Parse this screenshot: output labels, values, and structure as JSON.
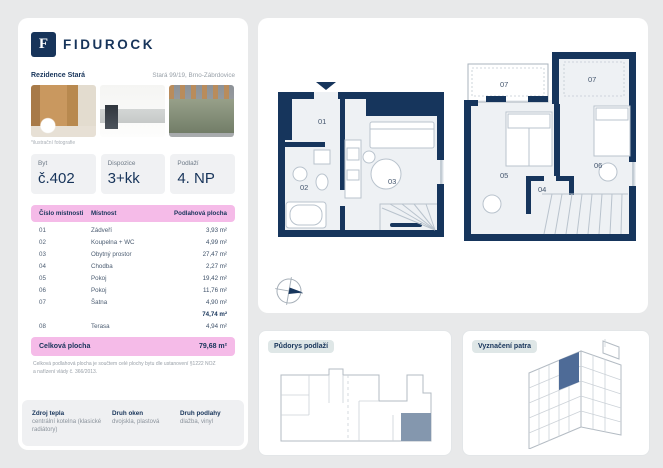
{
  "brand": {
    "name": "FIDUROCK",
    "logo_letter": "F"
  },
  "header": {
    "project": "Rezidence Stará",
    "address": "Stará 99/19, Brno-Zábrdovice"
  },
  "photos": {
    "caption": "*ilustrační fotografie"
  },
  "summary": {
    "items": [
      {
        "label": "Byt",
        "value": "č.402"
      },
      {
        "label": "Dispozice",
        "value": "3+kk"
      },
      {
        "label": "Podlaží",
        "value": "4. NP"
      }
    ]
  },
  "rooms": {
    "headers": {
      "no": "Číslo místnosti",
      "name": "Místnost",
      "area": "Podlahová plocha"
    },
    "rows": [
      {
        "no": "01",
        "name": "Zádveří",
        "area": "3,93 m²"
      },
      {
        "no": "02",
        "name": "Koupelna + WC",
        "area": "4,99 m²"
      },
      {
        "no": "03",
        "name": "Obytný prostor",
        "area": "27,47 m²"
      },
      {
        "no": "04",
        "name": "Chodba",
        "area": "2,27 m²"
      },
      {
        "no": "05",
        "name": "Pokoj",
        "area": "19,42 m²"
      },
      {
        "no": "06",
        "name": "Pokoj",
        "area": "11,76 m²"
      },
      {
        "no": "07",
        "name": "Šatna",
        "area": "4,90 m²"
      }
    ],
    "subtotal": "74,74 m²",
    "terrace_row": {
      "no": "08",
      "name": "Terasa",
      "area": "4,94 m²"
    },
    "total": {
      "label": "Celková plocha",
      "value": "79,68 m²"
    },
    "footnote": "Celková podlahová plocha je součtem celé plochy bytu dle ustanovení §1222 NOZ a nařízení vlády č. 366/2013."
  },
  "details": {
    "items": [
      {
        "label": "Zdroj tepla",
        "value": "centrální kotelna (klasické radiátory)"
      },
      {
        "label": "Druh oken",
        "value": "dvojskla, plastová"
      },
      {
        "label": "Druh podlahy",
        "value": "dlažba, vinyl"
      }
    ]
  },
  "floorplan": {
    "labels": {
      "r01": "01",
      "r02": "02",
      "r03": "03",
      "r04": "04",
      "r05": "05",
      "r06": "06",
      "r07a": "07",
      "r07b": "07"
    }
  },
  "panels": {
    "pudorys": {
      "title": "Půdorys podlaží"
    },
    "vyznaceni": {
      "title": "Vyznačení patra"
    }
  },
  "colors": {
    "brand_navy": "#17345a",
    "accent_pink": "#f5bbe8",
    "unit_highlight": "#8497ae",
    "floor_highlight": "#4e6b97"
  }
}
